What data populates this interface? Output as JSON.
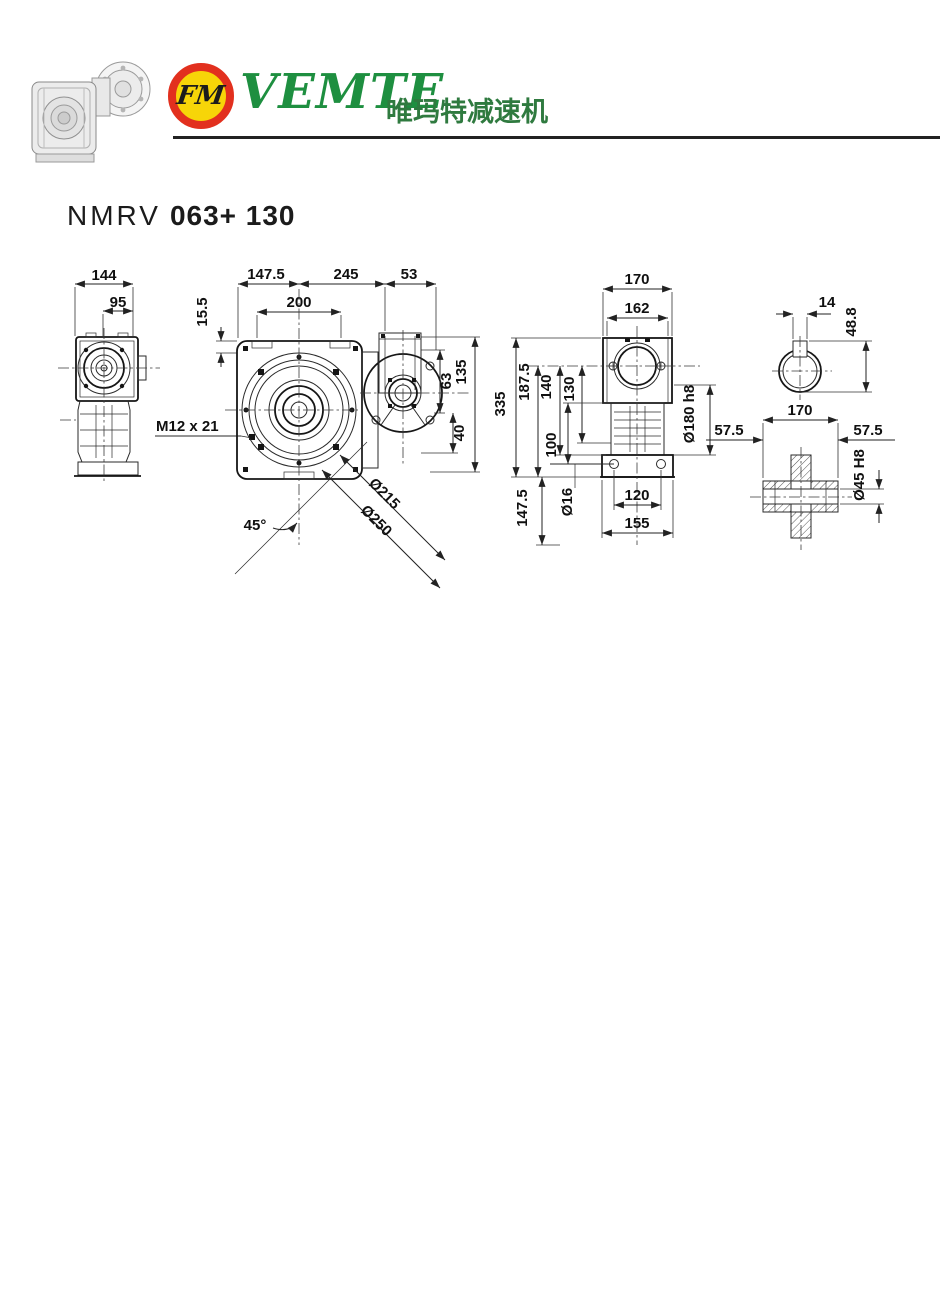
{
  "header": {
    "badge_text": "FM",
    "brand": "VEMTE",
    "brand_cn": "唯玛特减速机",
    "colors": {
      "brand_green": "#1e8f40",
      "badge_red": "#e2301e",
      "badge_yellow": "#f7d508",
      "line_black": "#222222"
    }
  },
  "title": {
    "series": "NMRV",
    "model": "063+ 130"
  },
  "drawing": {
    "side_view": {
      "dim_overall_width": "144",
      "dim_inner_width": "95"
    },
    "front_view": {
      "dim_left_to_axis": "147.5",
      "dim_axis_to_flange": "245",
      "dim_flange_depth": "53",
      "dim_mount_width": "200",
      "dim_top_offset": "15.5",
      "thread_label": "M12 x 21",
      "angle_label": "45°",
      "dim_bolt_circle": "Ø215",
      "dim_flange_od": "Ø250",
      "dim_adapter_height": "135",
      "dim_adapter_upper": "63",
      "dim_adapter_lower": "40"
    },
    "rear_view": {
      "dim_overall_width": "170",
      "dim_flange_width": "162",
      "dim_overall_height": "335",
      "dim_axis_to_base": "187.5",
      "dim_h140": "140",
      "dim_h130": "130",
      "dim_h147_5": "147.5",
      "dim_h100": "100",
      "dim_spigot": "Ø180 h8",
      "dim_foot_hole": "Ø16",
      "dim_hole_cc": "120",
      "dim_base_width": "155"
    },
    "input_shaft": {
      "dim_key_width": "14",
      "dim_key_height": "48.8"
    },
    "output_shaft": {
      "dim_center_length": "170",
      "dim_left_ext": "57.5",
      "dim_right_ext": "57.5",
      "dim_bore": "Ø45 H8"
    }
  }
}
